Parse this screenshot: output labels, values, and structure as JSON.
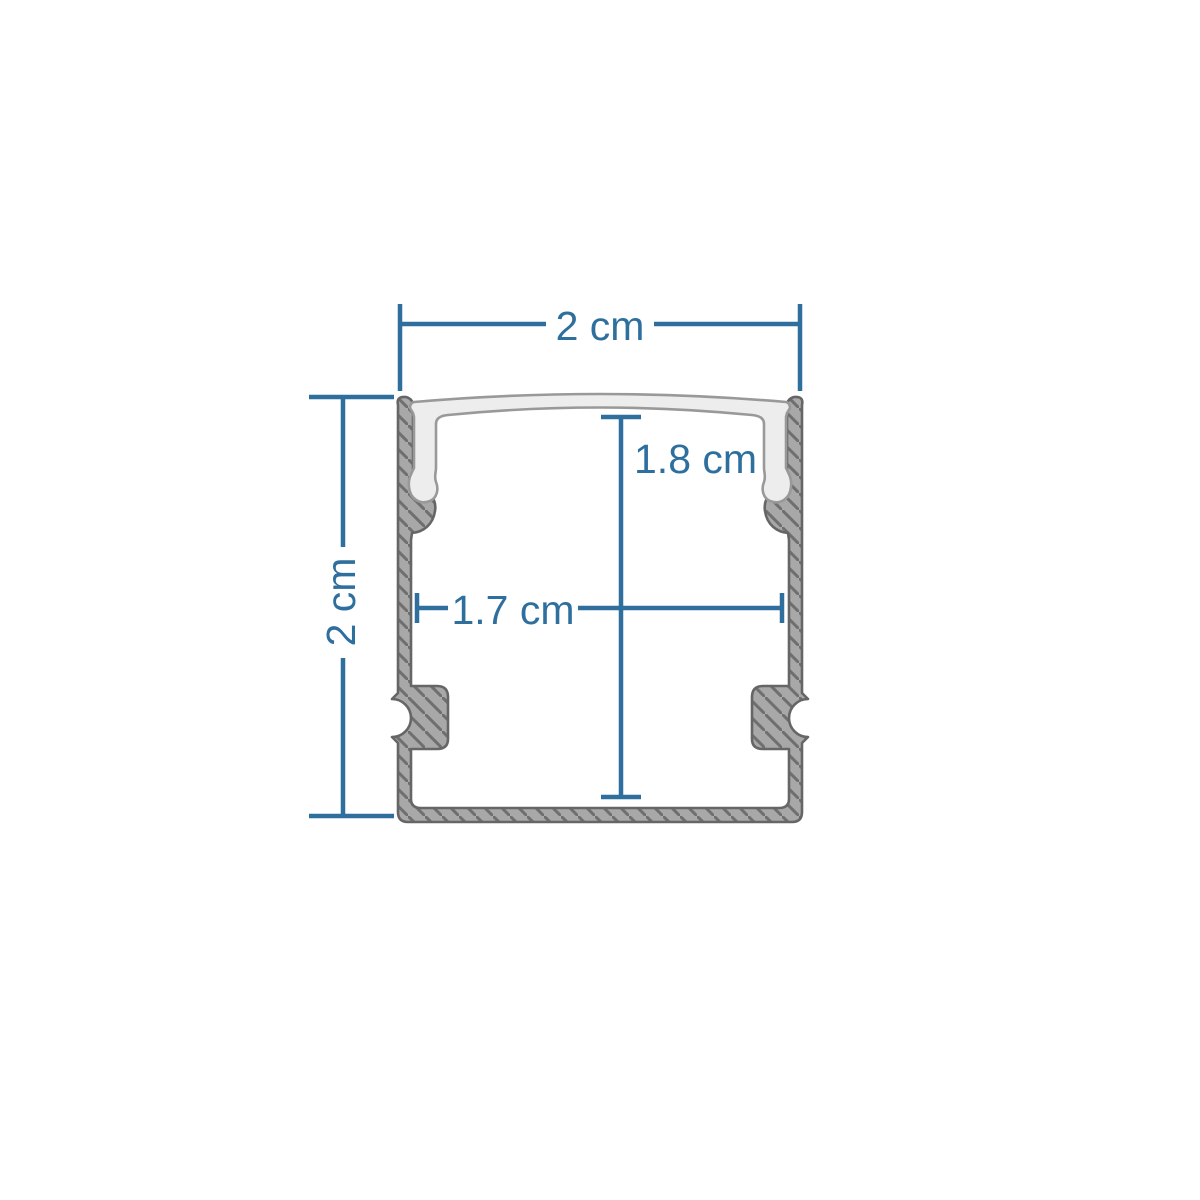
{
  "diagram": {
    "kind": "led-aluminium-profile-cross-section",
    "dimensions": {
      "top_width": {
        "label": "2 cm"
      },
      "overall_height": {
        "label": "2 cm"
      },
      "inner_height": {
        "label": "1.8 cm"
      },
      "inner_width": {
        "label": "1.7 cm"
      }
    },
    "colors": {
      "dimension": "#2E6F9E",
      "aluminum_fill": "#a8a8a8",
      "aluminum_hatch": "#6f6f6f",
      "aluminum_outline": "#666666",
      "cover_fill": "#ededed",
      "cover_outline": "#999999",
      "background": "#ffffff"
    }
  }
}
